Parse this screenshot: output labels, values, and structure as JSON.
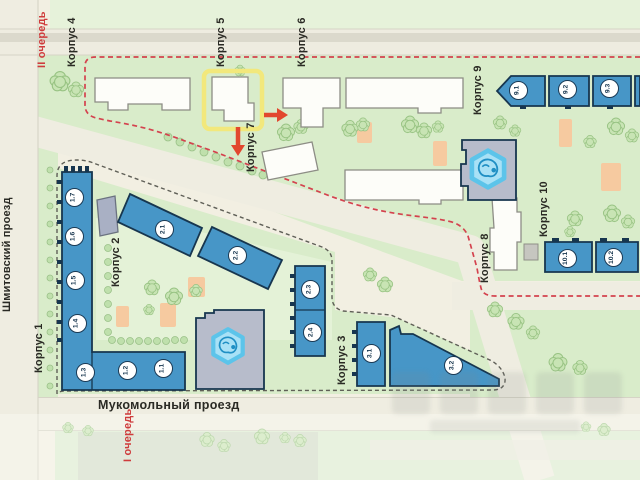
{
  "map": {
    "phase_labels": {
      "phase2": "II очередь",
      "phase1": "I очередь"
    },
    "streets": {
      "shmitovsky": "Шмитовский проезд",
      "mukomolny": "Мукомольный проезд"
    },
    "korpus_labels": [
      "Корпус 1",
      "Корпус 2",
      "Корпус 3",
      "Корпус 4",
      "Корпус 5",
      "Корпус 6",
      "Корпус 7",
      "Корпус 8",
      "Корпус 9",
      "Корпус 10"
    ],
    "units": [
      "1.1",
      "1.2",
      "1.3",
      "1.4",
      "1.5",
      "1.6",
      "1.7",
      "2.1",
      "2.2",
      "2.3",
      "2.4",
      "3.1",
      "3.2",
      "9.1",
      "9.2",
      "9.3",
      "10.1",
      "10.2"
    ],
    "highlighted_building": "Корпус 5",
    "colors": {
      "building_blue": "#4796c7",
      "building_outline": "#17364f",
      "highlight_yellow": "#f2e87c",
      "phase_boundary_red": "#d4424e",
      "phase_boundary_gray": "#5f5f57",
      "phase_text_red": "#cf3b3c",
      "green_area": "#d9ecca",
      "playground_orange": "#f6caa0",
      "pool_blue": "#a8e1f6"
    }
  }
}
